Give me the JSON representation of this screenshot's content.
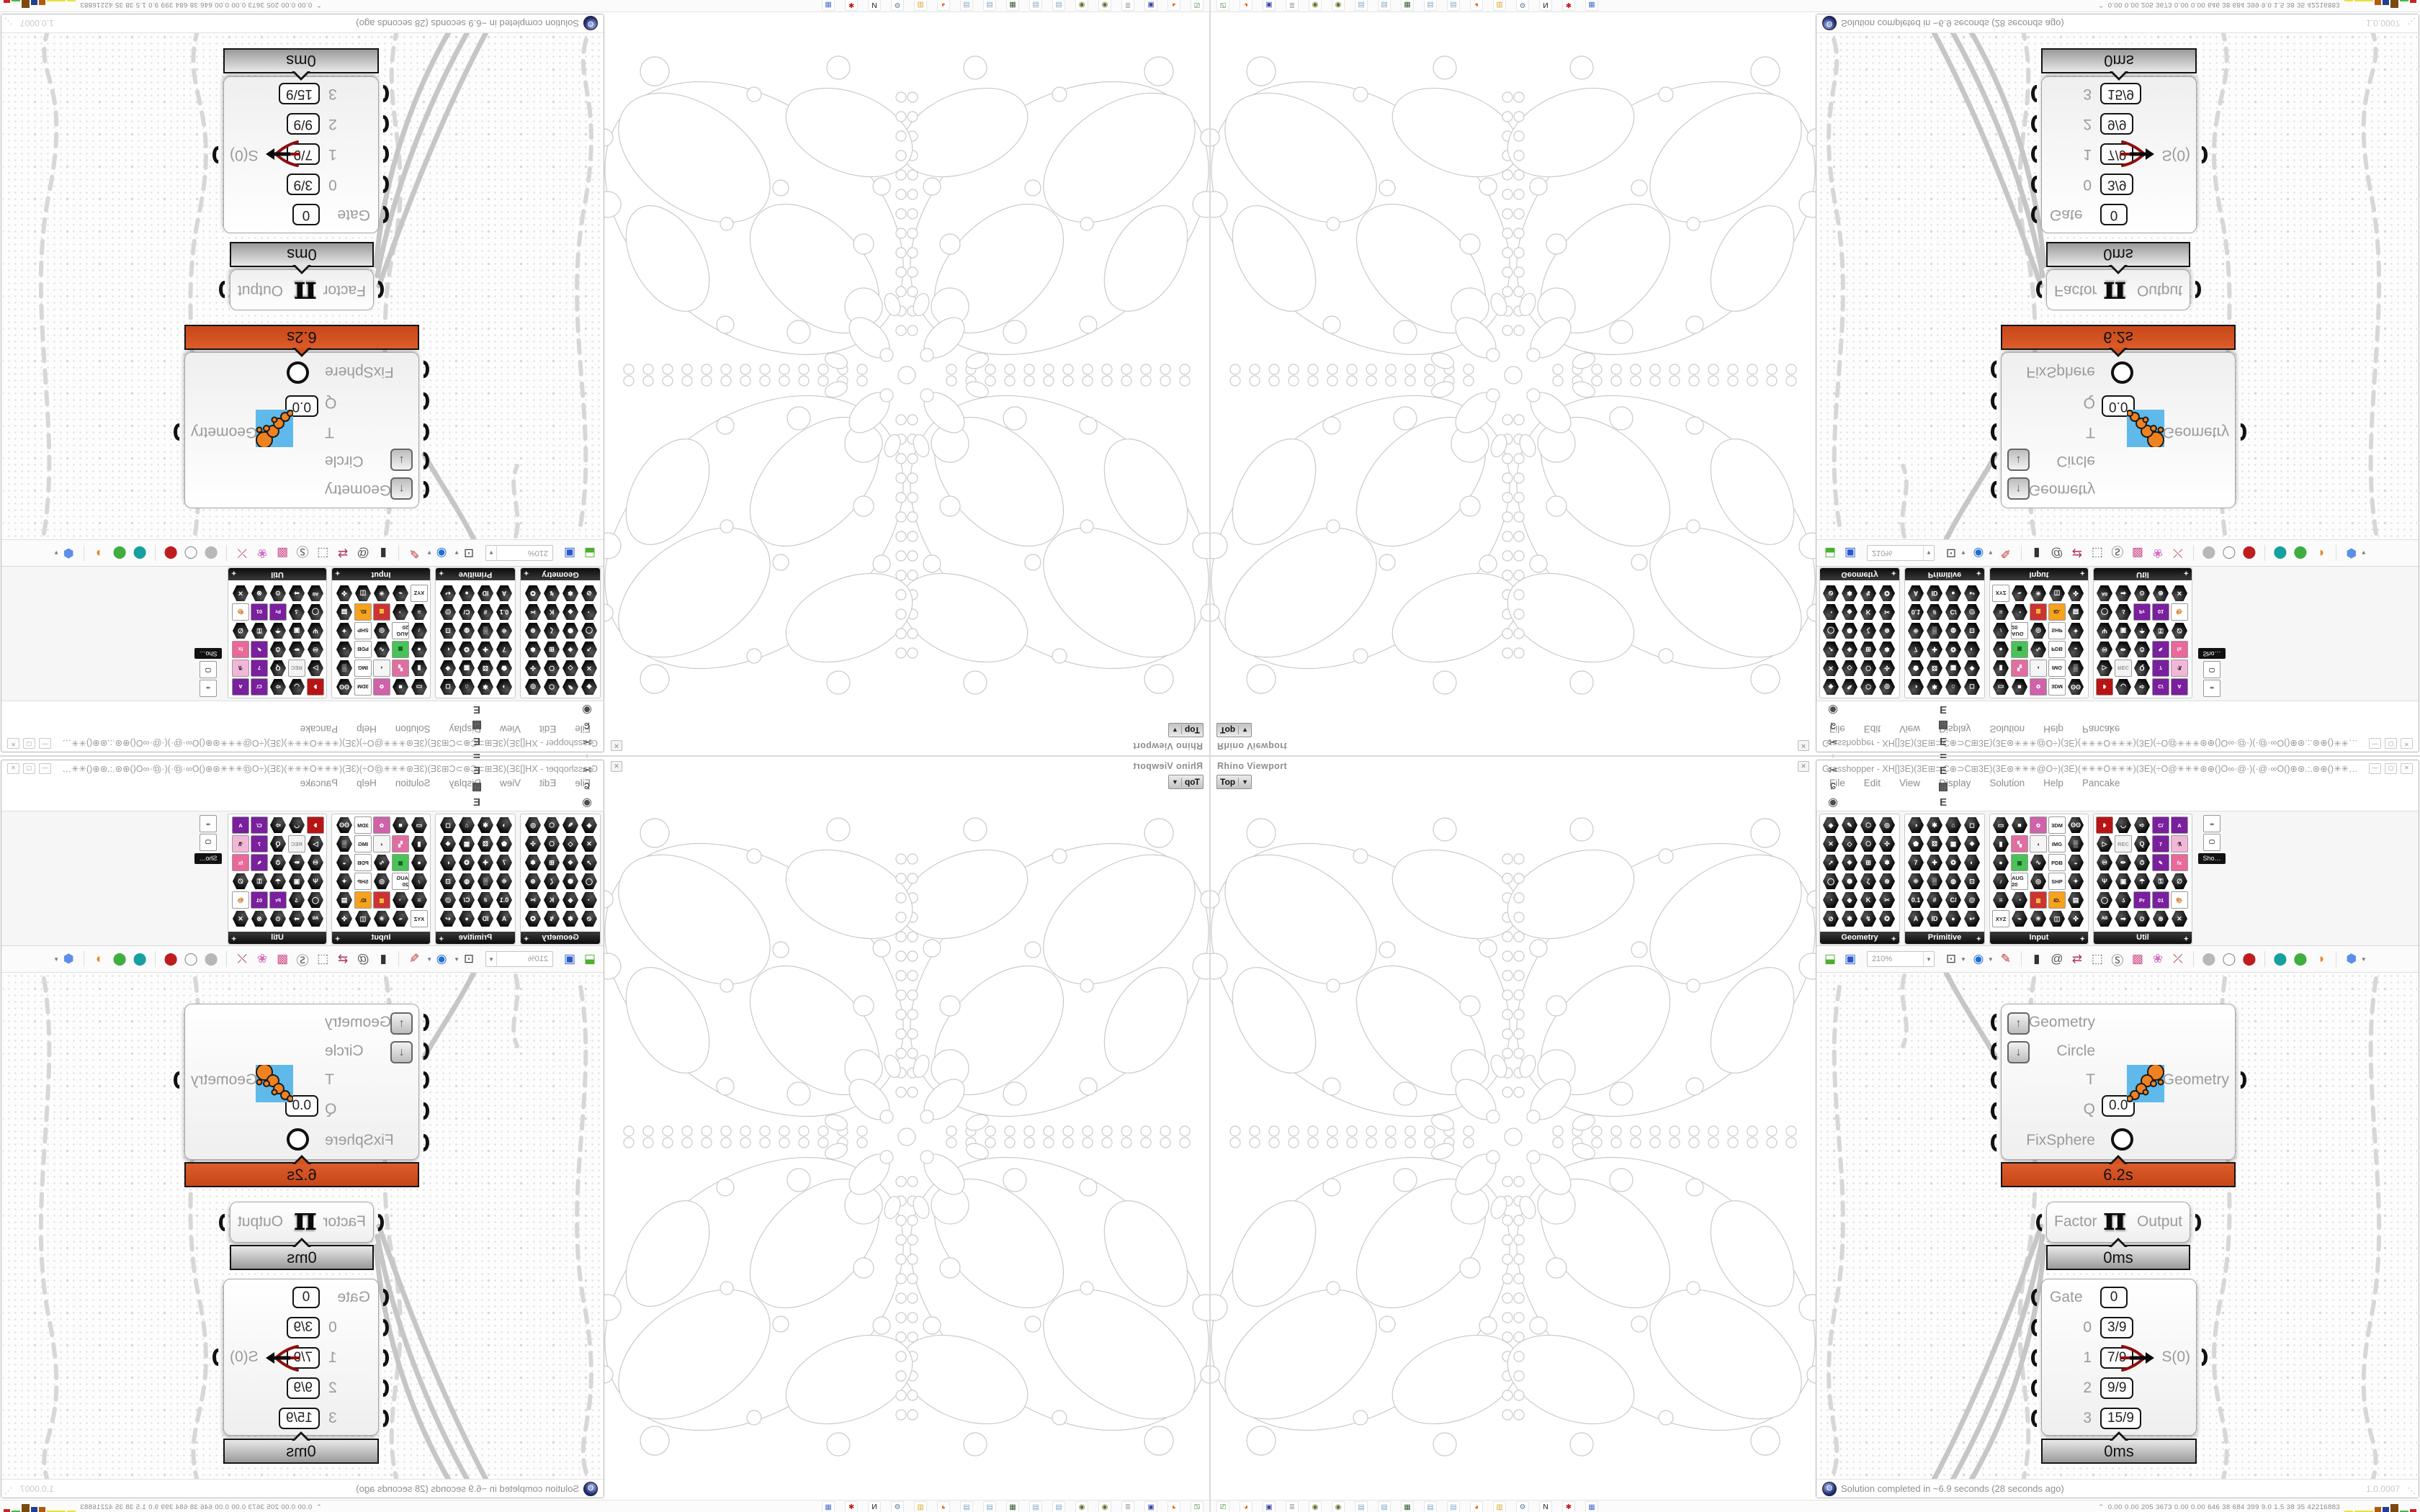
{
  "window": {
    "title": "Grasshopper - XH[]3E)(3E⊞⊃C⊕⊃C⊞3E)(3E⊛✳✳✳@O÷)(3E)(✳✳✳O✳✳✳)(3E)(÷O@✳✳✳⊛⊕()O∞·@·)(·@·∞O()⊕⊛.:.⊛⊕()✳✳✳3E()3E✳✳✳()⊕⊛.:.⊛⊕()O∞·@·)(·@·∞O()⊕⊛✳✳✳@O÷)(3E)(✳✳✳O✳✳✳()✳...",
    "buttons": {
      "minimize": "—",
      "maximize": "▢",
      "close": "✕"
    }
  },
  "menu": {
    "items": [
      "File",
      "Edit",
      "View",
      "Display",
      "Solution",
      "Help",
      "Pancake"
    ]
  },
  "tabs": {
    "left": [
      {
        "g": "",
        "cls": "active"
      },
      {
        "g": "Σ"
      },
      {
        "g": "Ψ"
      },
      {
        "g": "➚"
      },
      {
        "g": "ʊ"
      },
      {
        "g": "◗"
      },
      {
        "g": "▼"
      },
      {
        "g": "✂"
      },
      {
        "g": "ɕ"
      },
      {
        "g": "◉"
      }
    ],
    "right": [
      {
        "g": "A"
      },
      {
        "g": "◆",
        "color": "#35c99b"
      },
      {
        "g": "❁",
        "color": "#8a8a8a"
      },
      {
        "g": "A"
      },
      {
        "g": "B"
      },
      {
        "g": "▲"
      },
      {
        "g": "B"
      },
      {
        "g": "⬟",
        "color": "#333333"
      },
      {
        "g": "▦"
      },
      {
        "g": "⬬",
        "color": "#e87c1e"
      },
      {
        "g": "C"
      },
      {
        "g": "♞",
        "color": "#1a1a1a"
      },
      {
        "g": "D"
      },
      {
        "g": "D"
      },
      {
        "g": "E"
      },
      {
        "g": "E"
      },
      {
        "g": "▩"
      },
      {
        "g": "E"
      }
    ]
  },
  "panels": [
    {
      "name": "Geometry",
      "cols": 4,
      "icons": [
        "◈",
        "✎",
        "⬡",
        "◎",
        "✕",
        "◇",
        "⎔",
        "✣",
        "➚",
        "❖",
        "⊞",
        "✽",
        "◯",
        "⬢",
        "ζ",
        "⊛",
        "◔",
        "◆",
        "K",
        "✂",
        "⊘",
        "❃",
        "↯",
        "✪"
      ]
    },
    {
      "name": "Primitive",
      "cols": 4,
      "icons": [
        "◑",
        "✱",
        "⌂",
        "◻",
        "⬟",
        "⚄",
        "▦",
        "❖",
        "7",
        "✚",
        "❂",
        "◐",
        "⁜",
        "▒",
        "◍",
        "⊡",
        "0.1",
        "#",
        "C/",
        "@",
        "A",
        "ID",
        "●",
        "↩"
      ]
    },
    {
      "name": "Input",
      "cols": 5,
      "icons": [
        "▭",
        "■",
        {
          "label": "✿",
          "bg": "#cf62a8",
          "fg": "#ffffff"
        },
        {
          "label": "3DM"
        },
        "ʘʘ",
        "▮",
        {
          "label": "▚",
          "bg": "#e06ea0",
          "fg": "#ffffff"
        },
        {
          "label": "◖",
          "bg": "#f5f5f5"
        },
        {
          "label": "IMG"
        },
        "▒",
        "●",
        {
          "label": "▦",
          "bg": "#49c257",
          "fg": "#1a5c1f"
        },
        "∿",
        {
          "label": "PDB"
        },
        "◒",
        "♪",
        {
          "label": "AUG 20"
        },
        "◎",
        {
          "label": "SHP"
        },
        "✦",
        "≡",
        "◔",
        {
          "label": "▥",
          "bg": "#cc3333",
          "fg": "#ffe23a"
        },
        {
          "label": "ID.",
          "bg": "#f6a21c"
        },
        "▤",
        {
          "label": "XYZ"
        },
        "⌁",
        "☀",
        "◫",
        "✜"
      ]
    },
    {
      "name": "Util",
      "cols": 5,
      "icons": [
        {
          "label": "❥",
          "bg": "#b81414",
          "fg": "#ffffff"
        },
        "◡",
        "➪",
        {
          "label": "C/",
          "bg": "#7a1f9e",
          "fg": "#ffffff"
        },
        {
          "label": "A",
          "bg": "#7a1f9e",
          "fg": "#ffffff"
        },
        "▷",
        {
          "label": "REC",
          "bg": "#f3f3f3",
          "fg": "#999999"
        },
        "Q",
        {
          "label": "7",
          "bg": "#7a1f9e",
          "fg": "#ffffff"
        },
        {
          "label": "⚗",
          "bg": "#f2b7d8"
        },
        "♾",
        "✏",
        "⏱",
        {
          "label": "✎",
          "bg": "#7a1f9e",
          "fg": "#ffffff"
        },
        {
          "label": "fx",
          "bg": "#e8699a",
          "fg": "#ffffff"
        },
        "Ψ",
        "▣",
        "☂",
        "⚿",
        "∅",
        "◯",
        "ડ",
        {
          "label": "Pr",
          "bg": "#7a1f9e",
          "fg": "#ffffff"
        },
        {
          "label": "01",
          "bg": "#7a1f9e",
          "fg": "#ffffff"
        },
        {
          "label": "🎨",
          "bg": "#ffffff"
        },
        "ᴬᴮ",
        "➡",
        "⊙",
        "⊗",
        "✕"
      ]
    }
  ],
  "sho_panel": {
    "label": "Sho…",
    "icons": [
      "∞",
      "🖵"
    ]
  },
  "toolbar": {
    "zoom": "210%",
    "left_icons": [
      {
        "g": "⬓",
        "c": "#4caf2f"
      },
      {
        "g": "▣",
        "c": "#2b59c9"
      }
    ],
    "right_icons": [
      {
        "g": "⊡",
        "c": "#444444",
        "dd": true
      },
      {
        "g": "◉",
        "c": "#1f6fd0",
        "dd": true
      },
      {
        "g": "✎",
        "c": "#c23333"
      },
      {
        "g": "|",
        "c": "#dddddd"
      },
      {
        "g": "▮",
        "c": "#333333"
      },
      {
        "g": "@",
        "c": "#555555"
      },
      {
        "g": "⇄",
        "c": "#b03355"
      },
      {
        "g": "⬚",
        "c": "#666666"
      },
      {
        "g": "Ⓢ",
        "c": "#555555"
      },
      {
        "g": "▩",
        "c": "#d0558f"
      },
      {
        "g": "❀",
        "c": "#d06fc0"
      },
      {
        "g": "⤫",
        "c": "#a33344"
      },
      {
        "g": "|",
        "c": "#dddddd"
      },
      {
        "g": "⬤",
        "c": "#b8b8b8"
      },
      {
        "g": "◯",
        "c": "#888888"
      },
      {
        "g": "⬤",
        "c": "#bf1d1d"
      },
      {
        "g": "|",
        "c": "#dddddd"
      },
      {
        "g": "⬤",
        "c": "#18a0a0"
      },
      {
        "g": "⬤",
        "c": "#3fae3f"
      },
      {
        "g": "◑",
        "c": "#e8821e"
      },
      {
        "g": "|",
        "c": "#dddddd"
      },
      {
        "g": "⬢",
        "c": "#5b8fe8",
        "dd": true
      }
    ]
  },
  "canvas": {
    "component": {
      "inputs": [
        "Geometry",
        "Circle",
        "T",
        "Q",
        "FixSphere"
      ],
      "q_value": "0.0",
      "output": "Geometry",
      "time": "6.2s"
    },
    "pi": {
      "input": "Factor",
      "glyph": "π",
      "output": "Output",
      "time": "0ms"
    },
    "gate": {
      "rows": [
        {
          "label": "Gate",
          "value": "0"
        },
        {
          "label": "0",
          "value": "3/9"
        },
        {
          "label": "1",
          "value": "7/9"
        },
        {
          "label": "2",
          "value": "9/9"
        },
        {
          "label": "3",
          "value": "15/9"
        }
      ],
      "output": "S(0)",
      "time": "0ms"
    },
    "version": "1.0.0007"
  },
  "status": {
    "text": "Solution completed in ~6.9 seconds (28 seconds ago)"
  },
  "viewport": {
    "title": "Rhino Viewport",
    "view": "Top",
    "close": "✕"
  },
  "taskbar": {
    "icons": [
      {
        "g": "⎚",
        "c": "#2e7d32"
      },
      {
        "g": "◕",
        "c": "#e66000"
      },
      {
        "g": "▣",
        "c": "#3949ab"
      },
      {
        "g": "≣",
        "c": "#9e9e9e"
      },
      {
        "g": "◉",
        "c": "#6b6b2a"
      },
      {
        "g": "◉",
        "c": "#6b6b2a"
      },
      {
        "g": "▤",
        "c": "#7fa8c9"
      },
      {
        "g": "▤",
        "c": "#7fa8c9"
      },
      {
        "g": "▦",
        "c": "#2f5e2f"
      },
      {
        "g": "▤",
        "c": "#7fa8c9"
      },
      {
        "g": "▤",
        "c": "#7fa8c9"
      },
      {
        "g": "◕",
        "c": "#e66000"
      },
      {
        "g": "▥",
        "c": "#d9a62e"
      },
      {
        "g": "⚙",
        "c": "#5c7a9e"
      },
      {
        "g": "N",
        "c": "#111111"
      },
      {
        "g": "✱",
        "c": "#c01818"
      },
      {
        "g": "▦",
        "c": "#4a6fd0"
      }
    ],
    "tray_chevron": "⌃",
    "tray_numbers": "0.00 0.00  205 3673 0.00 0.00  646    38    684   399   9.0    1.5    38     35   42216883",
    "tray_bars": [
      {
        "w": 12,
        "h": 2,
        "c": "#e8e23a"
      },
      {
        "w": 26,
        "h": 2,
        "c": "#e8e23a"
      },
      {
        "w": 9,
        "h": 7,
        "c": "#b05a10"
      },
      {
        "w": 9,
        "h": 7,
        "c": "#1f3f8f"
      },
      {
        "w": 11,
        "h": 11,
        "c": "#7a4a10"
      },
      {
        "w": 12,
        "h": 2,
        "c": "#44bb44"
      },
      {
        "w": 9,
        "h": 4,
        "c": "#cc2222"
      }
    ]
  }
}
